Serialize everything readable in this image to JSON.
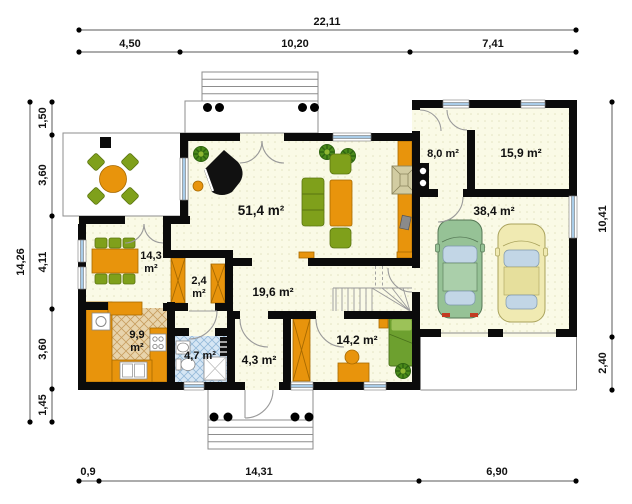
{
  "plan_title": "House ground floor plan",
  "dimensions": {
    "top_total": "22,11",
    "top_segments": [
      "4,50",
      "10,20",
      "7,41"
    ],
    "left_total": "14,26",
    "left_segments": [
      "1,50",
      "3,60",
      "4,11",
      "3,60",
      "1,45"
    ],
    "right_segments": [
      "10,41",
      "2,40"
    ],
    "bottom_segments": [
      "0,9",
      "14,31",
      "6,90"
    ]
  },
  "rooms": {
    "living": "51,4 m²",
    "dining_value": "14,3",
    "dining_unit": "m²",
    "pantry_value": "2,4",
    "pantry_unit": "m²",
    "hall": "19,6 m²",
    "kitchen_value": "9,9",
    "kitchen_unit": "m²",
    "bathroom": "4,7 m²",
    "vestibule": "4,3 m²",
    "bedroom": "14,2 m²",
    "utility": "8,0 m²",
    "room2": "15,9 m²",
    "garage": "38,4 m²"
  },
  "colors": {
    "wall": "#0b0b0b",
    "floor": "#fafae6",
    "accent_orange": "#e8940c",
    "furniture_green": "#7fa01b",
    "window_blue": "#a9cce8",
    "car_green": "#96c296",
    "car_yellow": "#f0eab2"
  }
}
